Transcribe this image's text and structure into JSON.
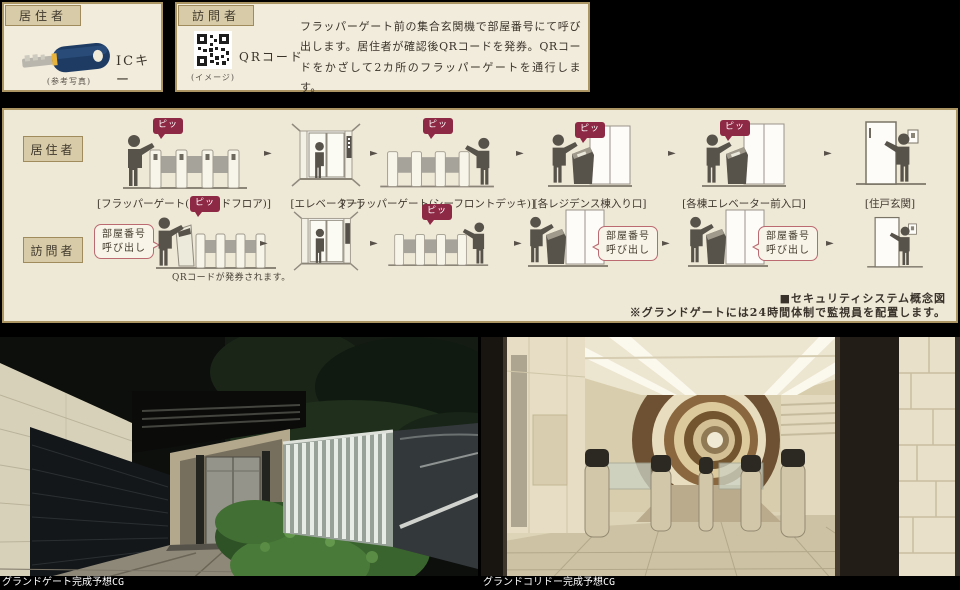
{
  "colors": {
    "panel_bg": "#f2ecdc",
    "panel_border": "#ab9663",
    "tag_bg": "#d8cba8",
    "beep_red": "#8e2945",
    "flow_bg": "#eee8d7"
  },
  "icons": {
    "flow_arrow": "►"
  },
  "top": {
    "resident_panel": {
      "tag": "居住者",
      "item_label": "ICキー",
      "caption": "(参考写真)"
    },
    "visitor_panel": {
      "tag": "訪問者",
      "item_label": "QRコード",
      "caption": "(イメージ)",
      "description": "フラッパーゲート前の集合玄関機で部屋番号にて呼び出します。居住者が確認後QRコードを発券。QRコードをかざして2カ所のフラッパーゲートを通行します。"
    }
  },
  "flow": {
    "resident": {
      "tag": "居住者",
      "steps": [
        {
          "label": "[フラッパーゲート(グランドフロア)]"
        },
        {
          "label": "[エレベーター]"
        },
        {
          "label": "[フラッパーゲート(シーフロントデッキ)]"
        },
        {
          "label": "[各レジデンス棟入り口]"
        },
        {
          "label": "[各棟エレベーター前入口]"
        },
        {
          "label": "[住戸玄関]"
        }
      ]
    },
    "visitor": {
      "tag": "訪問者"
    },
    "beep": "ピッ",
    "room_call": "部屋番号\n呼び出し",
    "qr_issue_note": "QRコードが発券されます。",
    "diagram_note": "■セキュリティシステム概念図",
    "guard_note": "※グランドゲートには24時間体制で監視員を配置します。"
  },
  "photos": {
    "left_caption": "グランドゲート完成予想CG",
    "right_caption": "グランドコリドー完成予想CG"
  }
}
